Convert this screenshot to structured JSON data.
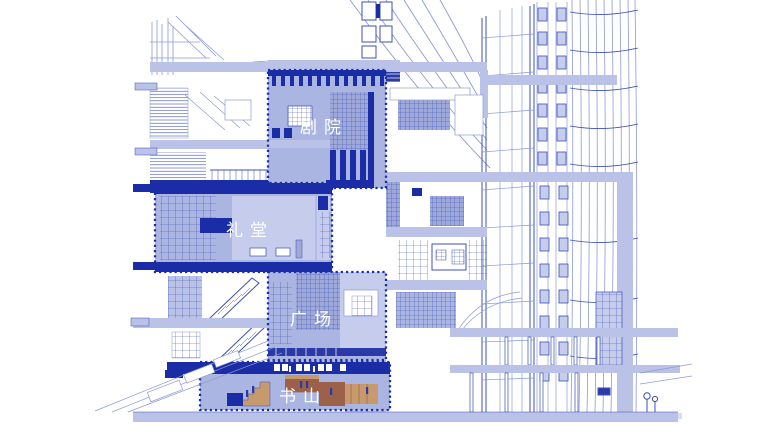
{
  "page": {
    "description": "Sectional axonometric architectural drawing, blue line style, four highlighted program volumes with dotted borders, wireframe tower at right, wooden book-mountain steps at bottom"
  },
  "labels": {
    "theater": "剧院",
    "auditorium": "礼堂",
    "plaza": "广场",
    "book_mountain": "书山"
  },
  "colors": {
    "accent": "#1b2da6",
    "accent_soft": "#2a3aa8",
    "fill_light": "#bac2e8",
    "fill_highlight": "#abb5e1",
    "fill_mid": "#9ea9da",
    "fill_pale": "#c6cdec",
    "line_strong": "#3c50b4",
    "line_soft": "#8d9ad4",
    "wood": "#9c6148",
    "wood_light": "#c79a6d",
    "label_text": "#ffffff"
  }
}
